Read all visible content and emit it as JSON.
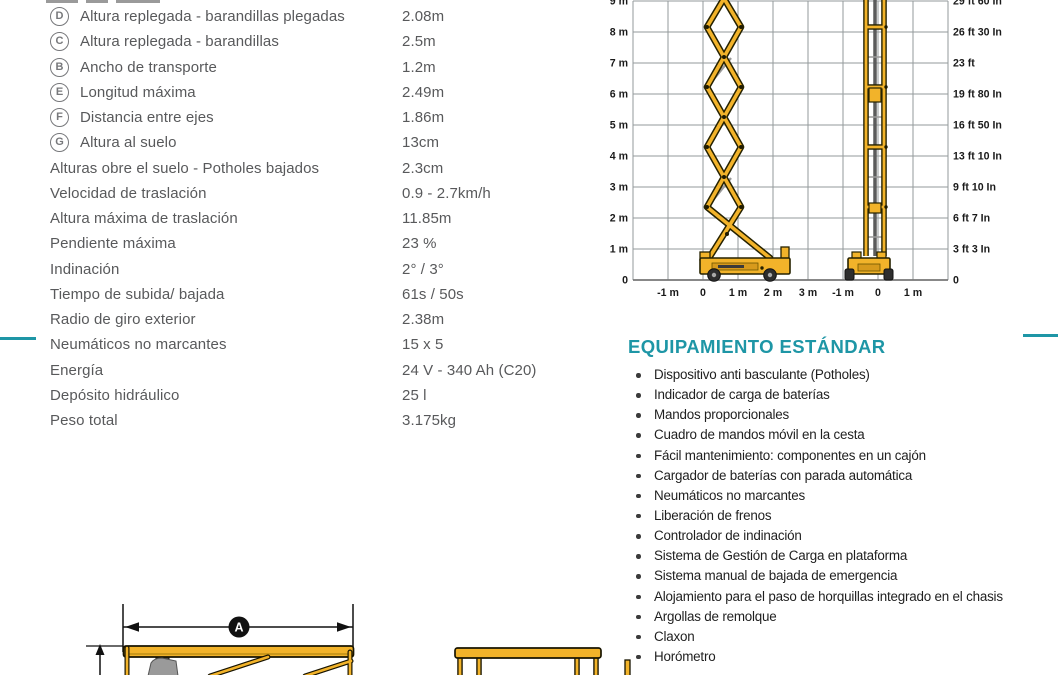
{
  "page": {
    "kind": "scissor-lift specification sheet (Spanish)",
    "accent_teal": "#1E96A6",
    "machine_yellow": "#F2B32A"
  },
  "specs": {
    "rows": [
      {
        "letter": "D",
        "label": "Altura replegada - barandillas plegadas",
        "value": "2.08m"
      },
      {
        "letter": "C",
        "label": "Altura replegada - barandillas",
        "value": "2.5m"
      },
      {
        "letter": "B",
        "label": "Ancho de transporte",
        "value": "1.2m"
      },
      {
        "letter": "E",
        "label": "Longitud máxima",
        "value": "2.49m"
      },
      {
        "letter": "F",
        "label": "Distancia entre ejes",
        "value": "1.86m"
      },
      {
        "letter": "G",
        "label": "Altura al suelo",
        "value": "13cm"
      },
      {
        "letter": "",
        "label": "Alturas obre el suelo - Potholes bajados",
        "value": "2.3cm"
      },
      {
        "letter": "",
        "label": "Velocidad de traslación",
        "value": "0.9 - 2.7km/h"
      },
      {
        "letter": "",
        "label": "Altura máxima de traslación",
        "value": "11.85m"
      },
      {
        "letter": "",
        "label": "Pendiente máxima",
        "value": "23 %"
      },
      {
        "letter": "",
        "label": "Indinación",
        "value": "2° / 3°"
      },
      {
        "letter": "",
        "label": "Tiempo de subida/ bajada",
        "value": "61s / 50s"
      },
      {
        "letter": "",
        "label": "Radio de giro exterior",
        "value": "2.38m"
      },
      {
        "letter": "",
        "label": "Neumáticos no marcantes",
        "value": "15 x 5"
      },
      {
        "letter": "",
        "label": "Energía",
        "value": "24 V - 340 Ah (C20)"
      },
      {
        "letter": "",
        "label": "Depósito hidráulico",
        "value": "25 l"
      },
      {
        "letter": "",
        "label": "Peso total",
        "value": "3.175kg"
      }
    ]
  },
  "diagram": {
    "left_axis_labels": [
      "9 m",
      "8 m",
      "7 m",
      "6 m",
      "5 m",
      "4 m",
      "3 m",
      "2 m",
      "1 m",
      "0"
    ],
    "right_axis_labels": [
      "29 ft 60 In",
      "26 ft 30 In",
      "23 ft",
      "19 ft 80 In",
      "16 ft 50 In",
      "13 ft 10 In",
      "9 ft 10 In",
      "6 ft 7 In",
      "3 ft 3 In",
      "0"
    ],
    "x_axis_labels_side_view": [
      "-1 m",
      "0",
      "1 m",
      "2 m",
      "3 m"
    ],
    "x_axis_labels_front_view": [
      "-1 m",
      "0",
      "1 m"
    ]
  },
  "equipment": {
    "title": "EQUIPAMIENTO ESTÁNDAR",
    "items": [
      "Dispositivo anti basculante (Potholes)",
      "Indicador de carga de baterías",
      "Mandos proporcionales",
      "Cuadro de mandos móvil en la cesta",
      "Fácil mantenimiento: componentes en un cajón",
      "Cargador de baterías con parada automática",
      "Neumáticos no marcantes",
      "Liberación de frenos",
      "Controlador de indinación",
      "Sistema de Gestión de Carga en plataforma",
      "Sistema manual de bajada de emergencia",
      "Alojamiento para el paso de horquillas integrado en el chasis",
      "Argollas de remolque",
      "Claxon",
      "Horómetro"
    ]
  },
  "footer_drawing": {
    "dimension_label": "A"
  }
}
